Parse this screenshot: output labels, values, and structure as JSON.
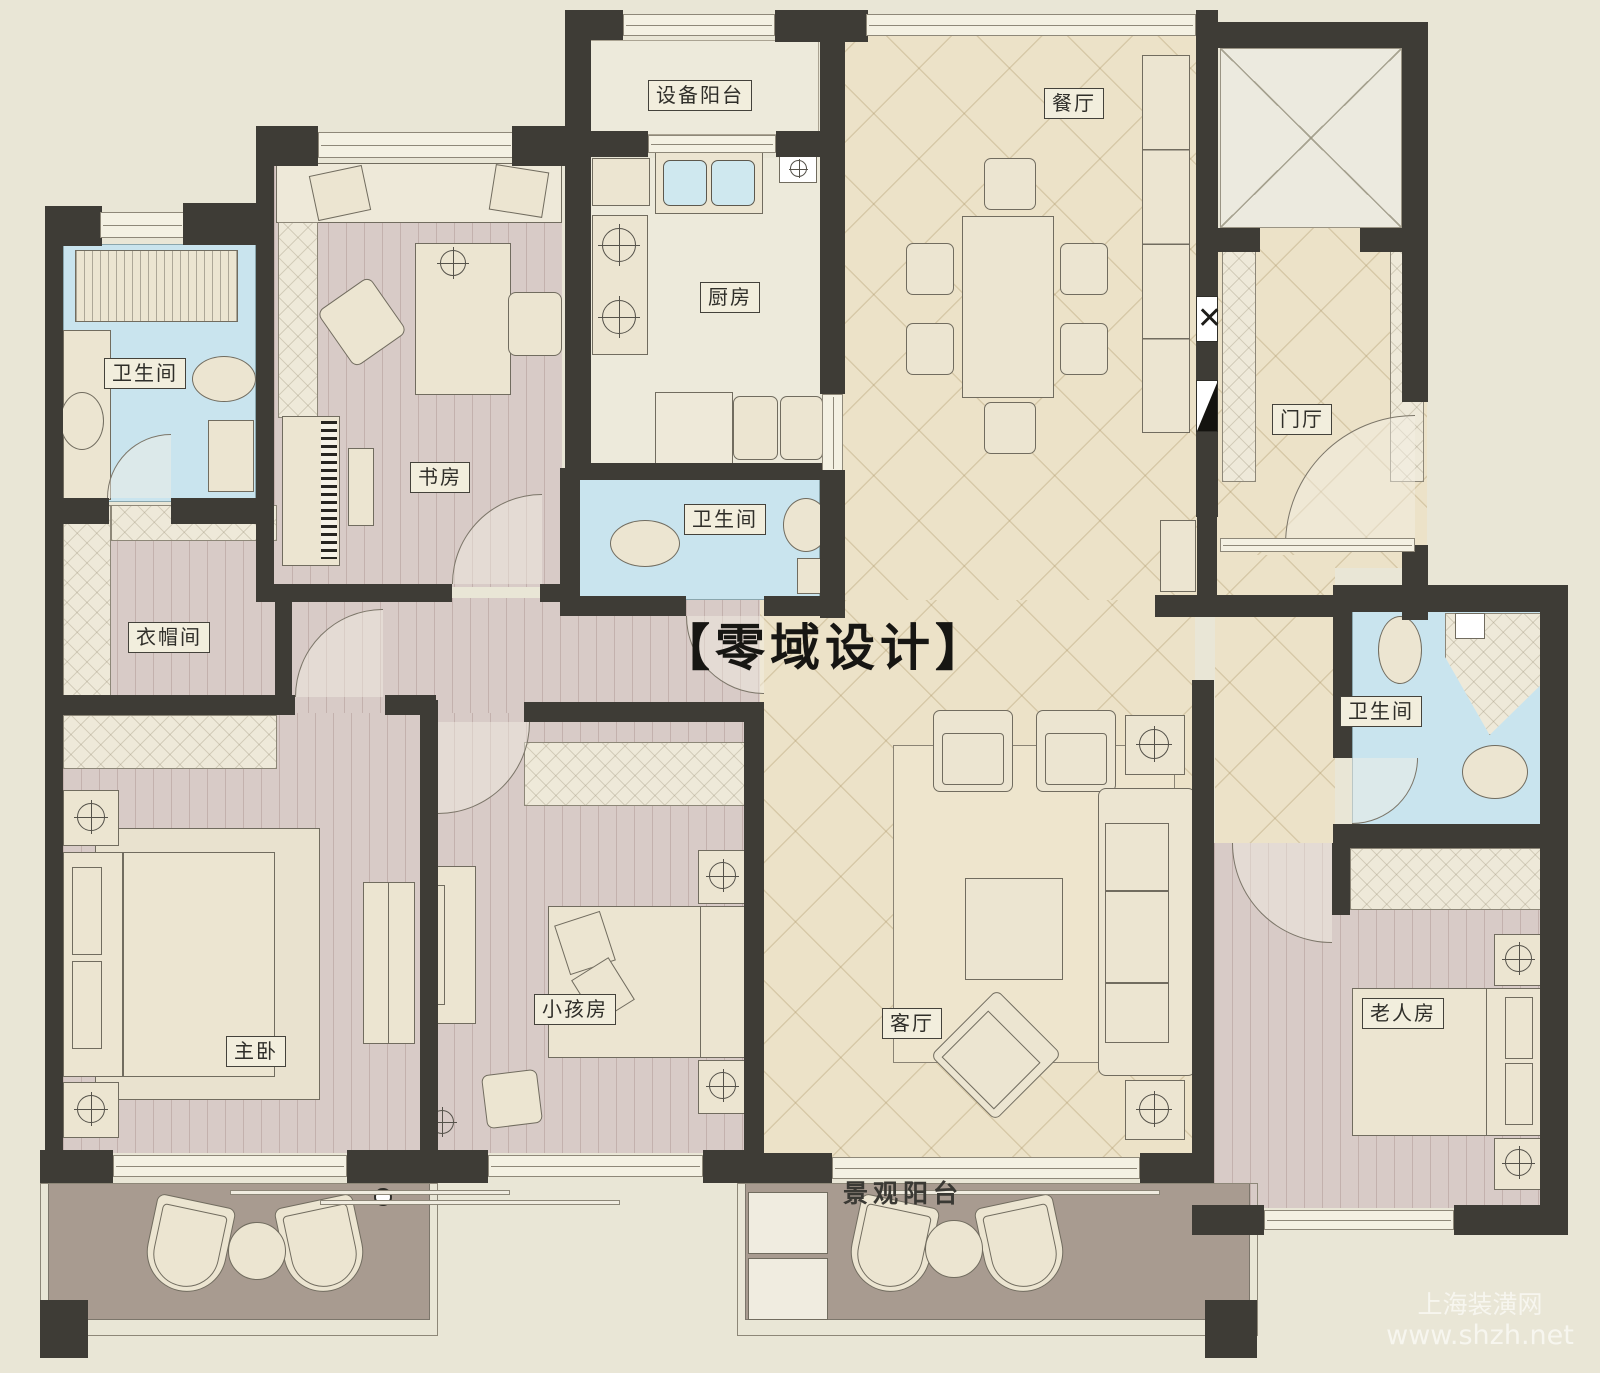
{
  "plan": {
    "title": "四室两厅户型平面图",
    "brand_watermark": "【零域设计】",
    "site_watermark_name": "上海装潢网",
    "site_watermark_url": "www.shzh.net",
    "rooms": {
      "equipment_balcony": "设备阳台",
      "dining_room": "餐厅",
      "kitchen": "厨房",
      "bathroom_top_left": "卫生间",
      "bathroom_middle": "卫生间",
      "bathroom_right": "卫生间",
      "study": "书房",
      "foyer": "门厅",
      "cloakroom": "衣帽间",
      "master_bedroom": "主卧",
      "kids_room": "小孩房",
      "living_room": "客厅",
      "elderly_room": "老人房",
      "view_balcony": "景观阳台"
    },
    "colors": {
      "wall": "#3e3c36",
      "tile_floor": "#ece2c8",
      "wood_floor": "#d8cbc7",
      "bathroom_floor": "#c9e4ee",
      "balcony_floor": "#a89b90",
      "background": "#e9e6d6"
    }
  }
}
